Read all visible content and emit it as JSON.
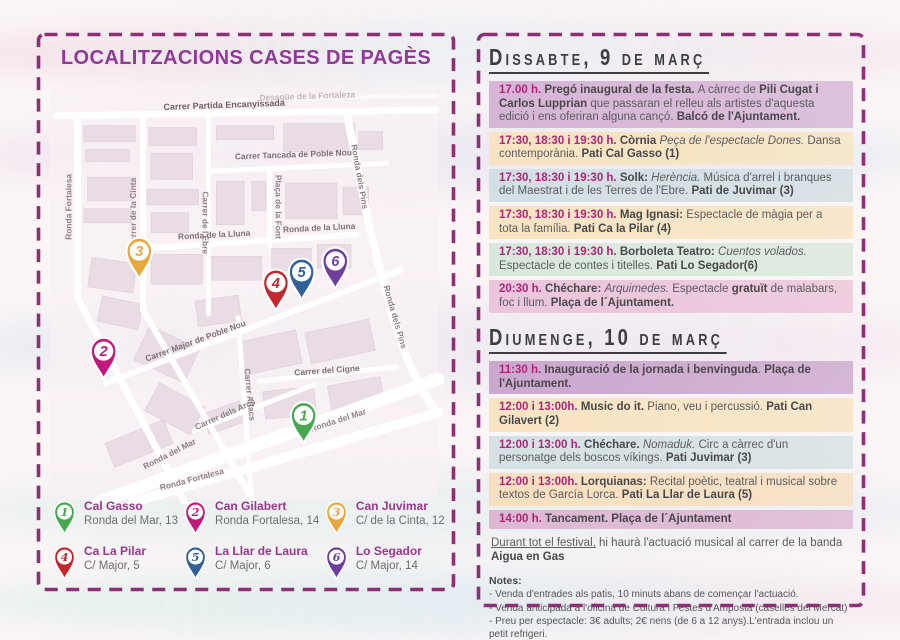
{
  "left_panel": {
    "title": "LOCALITZACIONS CASES DE PAGÈS",
    "map": {
      "street_labels": [
        {
          "t": "Desagüe de la Fortaleza",
          "x": 262,
          "y": 13,
          "r": -2,
          "s": 8.5,
          "c": "#c3b5bc"
        },
        {
          "t": "Carrer Partida Encanyissada",
          "x": 178,
          "y": 22,
          "r": -2,
          "s": 9,
          "c": "#6e5f67"
        },
        {
          "t": "Ronda Fortalesa",
          "x": 24,
          "y": 122,
          "r": -90,
          "s": 8.5,
          "c": "#8d7f87"
        },
        {
          "t": "Carrer de la Cinta",
          "x": 89,
          "y": 128,
          "r": -90,
          "s": 8.5,
          "c": "#8d7f87"
        },
        {
          "t": "Carrer de l'Ebre",
          "x": 156,
          "y": 138,
          "r": 90,
          "s": 8.5,
          "c": "#8d7f87"
        },
        {
          "t": "Carrer Tancada de Poble Nou",
          "x": 248,
          "y": 72,
          "r": -2,
          "s": 8.5,
          "c": "#7d6f77"
        },
        {
          "t": "Plaça de la Font",
          "x": 230,
          "y": 122,
          "r": 90,
          "s": 8.5,
          "c": "#8d7f87"
        },
        {
          "t": "Ronda de la Lluna",
          "x": 168,
          "y": 153,
          "r": -3,
          "s": 8.5,
          "c": "#7d6f77"
        },
        {
          "t": "Ronda de la Lluna",
          "x": 274,
          "y": 146,
          "r": -3,
          "s": 8.5,
          "c": "#7d6f77"
        },
        {
          "t": "Ronda dels Pins",
          "x": 312,
          "y": 92,
          "r": 80,
          "s": 8.5,
          "c": "#8d7f87"
        },
        {
          "t": "Ronda dels Pins",
          "x": 348,
          "y": 234,
          "r": 74,
          "s": 8.5,
          "c": "#8d7f87"
        },
        {
          "t": "Carrer Major de Poble Nou",
          "x": 150,
          "y": 260,
          "r": -20,
          "s": 8.5,
          "c": "#7d6f77"
        },
        {
          "t": "Carrer Alfacs",
          "x": 201,
          "y": 312,
          "r": 84,
          "s": 8.5,
          "c": "#8d7f87"
        },
        {
          "t": "Carrer dels Arcs",
          "x": 180,
          "y": 334,
          "r": -24,
          "s": 8.5,
          "c": "#8d7f87"
        },
        {
          "t": "Carrer del Cigne",
          "x": 282,
          "y": 290,
          "r": -4,
          "s": 8.5,
          "c": "#7d6f77"
        },
        {
          "t": "Ronda del Mar",
          "x": 124,
          "y": 374,
          "r": -27,
          "s": 8.5,
          "c": "#8d7f87"
        },
        {
          "t": "Ronda del Mar",
          "x": 294,
          "y": 340,
          "r": -18,
          "s": 8.5,
          "c": "#8d7f87"
        },
        {
          "t": "Ronda Fortalesa",
          "x": 146,
          "y": 400,
          "r": -15,
          "s": 8.5,
          "c": "#8d7f87"
        }
      ],
      "pins": [
        {
          "num": "1",
          "color": "#45a851",
          "x": 258,
          "y": 362
        },
        {
          "num": "2",
          "color": "#c21a7c",
          "x": 56,
          "y": 297
        },
        {
          "num": "3",
          "color": "#e8a73c",
          "x": 92,
          "y": 196
        },
        {
          "num": "4",
          "color": "#c2282e",
          "x": 230,
          "y": 228
        },
        {
          "num": "5",
          "color": "#31609b",
          "x": 256,
          "y": 217
        },
        {
          "num": "6",
          "color": "#6e3e9e",
          "x": 290,
          "y": 206
        }
      ]
    },
    "legend": [
      {
        "num": "1",
        "color": "#45a851",
        "name": "Cal Gasso",
        "address": "Ronda del Mar, 13"
      },
      {
        "num": "2",
        "color": "#c21a7c",
        "name": "Can Gilabert",
        "address": "Ronda Fortalesa, 14"
      },
      {
        "num": "3",
        "color": "#e8a73c",
        "name": "Can Juvimar",
        "address": "C/ de la Cinta, 12"
      },
      {
        "num": "4",
        "color": "#c2282e",
        "name": "Ca La Pilar",
        "address": "C/ Major, 5"
      },
      {
        "num": "5",
        "color": "#31609b",
        "name": "La Llar de Laura",
        "address": "C/ Major, 6"
      },
      {
        "num": "6",
        "color": "#6e3e9e",
        "name": "Lo Segador",
        "address": "C/ Major, 14"
      }
    ]
  },
  "right_panel": {
    "days": [
      {
        "title": "Dissabte, 9 de març",
        "events": [
          {
            "bg": "#d6b5d6",
            "segments": [
              {
                "t": "17.00 h. ",
                "s": "t"
              },
              {
                "t": "Pregó inaugural de la festa. ",
                "s": "b"
              },
              {
                "t": "A càrrec de ",
                "s": "n"
              },
              {
                "t": "Pili Cugat i Carlos Lupprian",
                "s": "b"
              },
              {
                "t": " que passaran el relleu als artistes d'aquesta edició i ens oferiran alguna cançó. ",
                "s": "n"
              },
              {
                "t": "Balcó de l'Ajuntament.",
                "s": "b"
              }
            ]
          },
          {
            "bg": "#f8e4c2",
            "segments": [
              {
                "t": "17:30, 18:30 i 19:30 h. ",
                "s": "t"
              },
              {
                "t": "Còrnia ",
                "s": "b"
              },
              {
                "t": "Peça de l'espectacle Dones.",
                "s": "i"
              },
              {
                "t": " Dansa contemporània. ",
                "s": "n"
              },
              {
                "t": "Pati Cal Gasso (1)",
                "s": "b"
              }
            ]
          },
          {
            "bg": "#d2dfe3",
            "segments": [
              {
                "t": "17:30, 18:30 i 19:30 h. ",
                "s": "t"
              },
              {
                "t": "Solk: ",
                "s": "b"
              },
              {
                "t": "Herència.",
                "s": "i"
              },
              {
                "t": " Música d'arrel i branques del Maestrat i de les Terres de l'Ebre. ",
                "s": "n"
              },
              {
                "t": "Pati de Juvimar (3)",
                "s": "b"
              }
            ]
          },
          {
            "bg": "#f8e4c2",
            "segments": [
              {
                "t": "17:30, 18:30 i 19:30 h. ",
                "s": "t"
              },
              {
                "t": "Mag Ignasi: ",
                "s": "b"
              },
              {
                "t": "Espectacle de màgia per a tota la família. ",
                "s": "n"
              },
              {
                "t": "Pati Ca la Pilar (4)",
                "s": "b"
              }
            ]
          },
          {
            "bg": "#d9e8dc",
            "segments": [
              {
                "t": "17:30, 18:30 i 19:30 h. ",
                "s": "t"
              },
              {
                "t": "Borboleta Teatro: ",
                "s": "b"
              },
              {
                "t": "Cuentos volados.",
                "s": "i"
              },
              {
                "t": " Espectacle de contes i titelles. ",
                "s": "n"
              },
              {
                "t": "Pati Lo Segador(6)",
                "s": "b"
              }
            ]
          },
          {
            "bg": "#ecc5db",
            "segments": [
              {
                "t": "20:30 h. ",
                "s": "t"
              },
              {
                "t": "Chéchare: ",
                "s": "b"
              },
              {
                "t": "Arquimedes.",
                "s": "i"
              },
              {
                "t": " Espectacle ",
                "s": "n"
              },
              {
                "t": "gratuït",
                "s": "b"
              },
              {
                "t": " de malabars, foc i llum. ",
                "s": "n"
              },
              {
                "t": "Plaça de l´Ajuntament.",
                "s": "b"
              }
            ]
          }
        ]
      },
      {
        "title": "Diumenge, 10 de març",
        "events": [
          {
            "bg": "#cca8cf",
            "segments": [
              {
                "t": "11:30 h. ",
                "s": "t"
              },
              {
                "t": "Inauguració de la jornada i benvinguda",
                "s": "b"
              },
              {
                "t": ". ",
                "s": "n"
              },
              {
                "t": "Plaça de l'Ajuntament.",
                "s": "b"
              }
            ]
          },
          {
            "bg": "#f8e4c2",
            "segments": [
              {
                "t": "12:00 i 13:00h. ",
                "s": "t"
              },
              {
                "t": "Music do it. ",
                "s": "b"
              },
              {
                "t": "Piano, veu i percussió. ",
                "s": "n"
              },
              {
                "t": "Pati Can Gilavert (2)",
                "s": "b"
              }
            ]
          },
          {
            "bg": "#d5e1e4",
            "segments": [
              {
                "t": "12:00 i 13:00 h. ",
                "s": "t"
              },
              {
                "t": "Chéchare. ",
                "s": "b"
              },
              {
                "t": "Nomaduk.",
                "s": "i"
              },
              {
                "t": " Circ a càrrec d'un personatge dels boscos víkings. ",
                "s": "n"
              },
              {
                "t": "Pati Juvimar (3)",
                "s": "b"
              }
            ]
          },
          {
            "bg": "#f8dfc0",
            "segments": [
              {
                "t": "12:00 i 13:00h. ",
                "s": "t"
              },
              {
                "t": "Lorquianas: ",
                "s": "b"
              },
              {
                "t": "Recital poètic, teatral i musical sobre textos de García Lorca. ",
                "s": "n"
              },
              {
                "t": "Pati La Llar de Laura (5)",
                "s": "b"
              }
            ]
          },
          {
            "bg": "#deb7d3",
            "segments": [
              {
                "t": "14:00 h. ",
                "s": "t"
              },
              {
                "t": "Tancament. Plaça de l´Ajuntament",
                "s": "b"
              }
            ]
          },
          {
            "bg": "",
            "segments": [
              {
                "t": "Durant tot el festival,",
                "s": "u"
              },
              {
                "t": " hi haurà l'actuació musical al carrer de la banda ",
                "s": "n"
              },
              {
                "t": "Aigua en Gas",
                "s": "b"
              }
            ]
          }
        ]
      }
    ],
    "notes": {
      "title": "Notes:",
      "lines": [
        "- Venda d'entrades als patis, 10 minuts abans de començar l'actuació.",
        "- Venda anticipada a l'oficina de Cultura i Festes d'Amposta (caselles del Mercat)",
        "- Preu per espectacle: 3€ adults; 2€ nens (de 6 a 12 anys).L'entrada inclou un petit refrigeri.",
        "- Durada aproximada dels espectacles: 20 minuts. Aforament limitat."
      ],
      "bold_line": "L'organització es reserva el dret de realitzar canvis en la programació."
    }
  },
  "colors": {
    "dashed_border": "#8e2f76",
    "title_purple": "#8e3a96",
    "time_magenta": "#ae2579",
    "heading_dark": "#3e3e40",
    "legend_name_purple": "#9c3690"
  }
}
